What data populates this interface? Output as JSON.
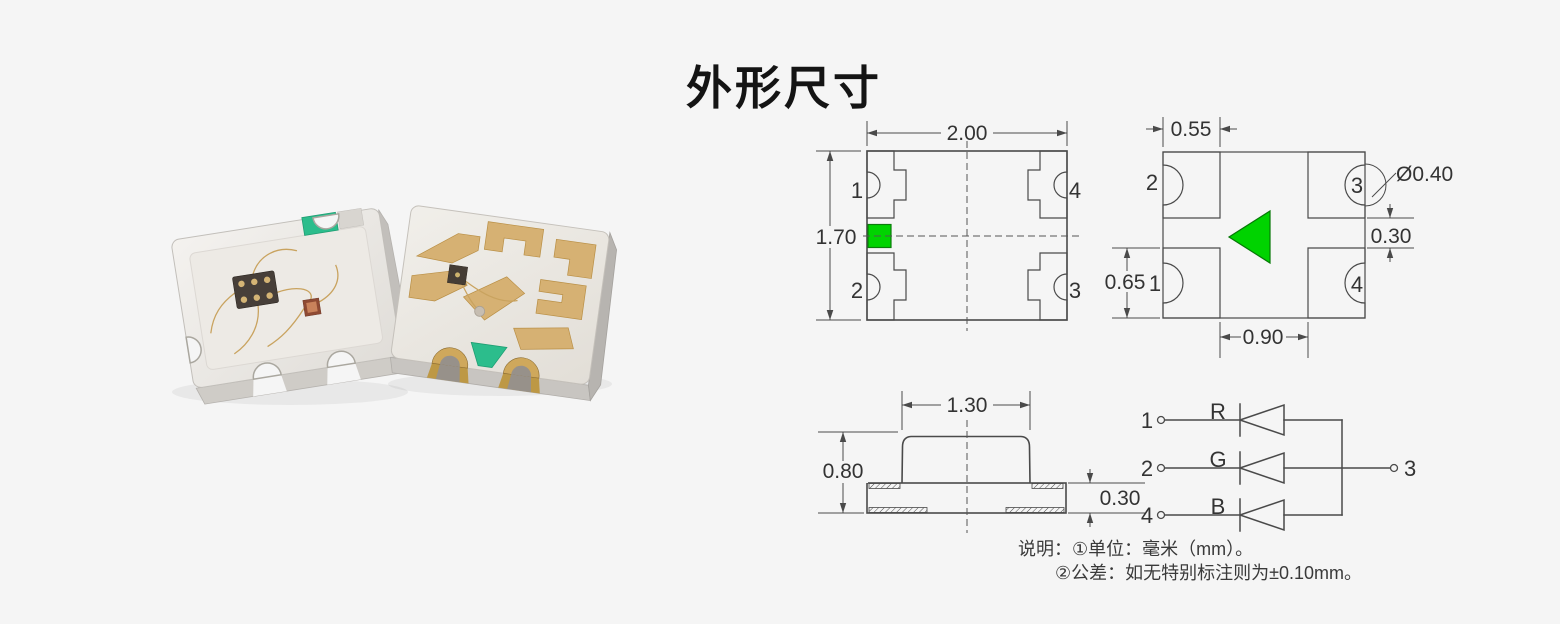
{
  "page": {
    "background": "#f5f5f5",
    "title": "外形尺寸"
  },
  "colors": {
    "line": "#4a4a4a",
    "text": "#333333",
    "green": "#00d300",
    "photo_green": "#2cbd8c",
    "photo_gold": "#d6b173"
  },
  "top_view": {
    "width": "2.00",
    "height": "1.70",
    "pad_top_left": "1",
    "pad_bottom_left": "2",
    "pad_top_right": "4",
    "pad_bottom_right": "3"
  },
  "bottom_view": {
    "pad_width": "0.55",
    "notch_diameter": "Ø0.40",
    "gap_vertical": "0.30",
    "pad_height": "0.65",
    "gap_horizontal": "0.90",
    "pad_top_left": "2",
    "pad_top_right": "3",
    "pad_bottom_left": "1",
    "pad_bottom_right": "4"
  },
  "side_view": {
    "lens_width": "1.30",
    "total_height": "0.80",
    "base_thickness": "0.30"
  },
  "circuit": {
    "rows": [
      {
        "pin": "1",
        "channel": "R"
      },
      {
        "pin": "2",
        "channel": "G"
      },
      {
        "pin": "4",
        "channel": "B"
      }
    ],
    "common_pin": "3"
  },
  "notes": {
    "line1": "说明：①单位：毫米（mm）。",
    "line2": "②公差：如无特别标注则为±0.10mm。"
  }
}
